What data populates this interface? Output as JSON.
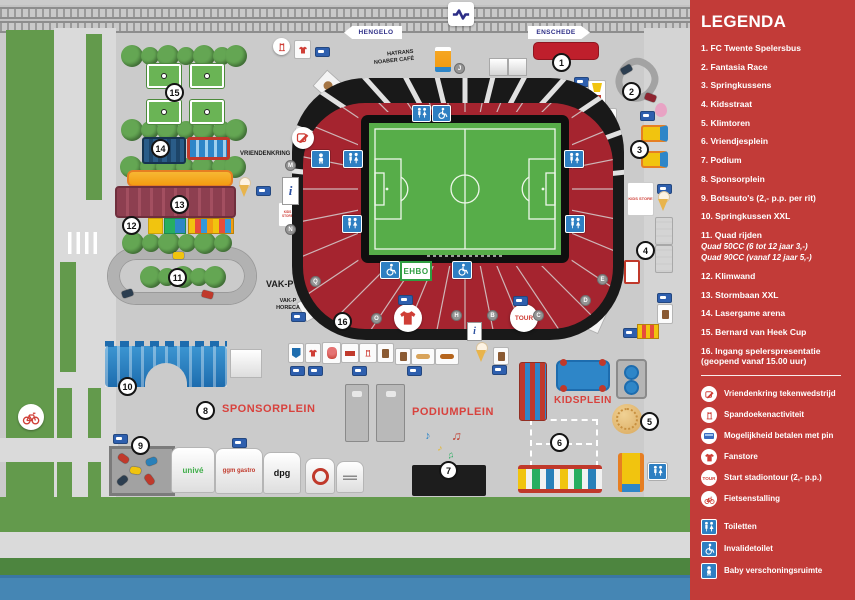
{
  "legend": {
    "title": "LEGENDA",
    "items": [
      "1. FC Twente Spelersbus",
      "2. Fantasia Race",
      "3. Springkussens",
      "4. Kidsstraat",
      "5. Klimtoren",
      "6. Vriendjesplein",
      "7. Podium",
      "8. Sponsorplein",
      "9. Botsauto's (2,- p.p. per rit)",
      "10. Springkussen XXL",
      "11. Quad rijden",
      "12. Klimwand",
      "13. Stormbaan XXL",
      "14. Lasergame arena",
      "15. Bernard van Heek Cup",
      "16. Ingang spelerspresentatie (geopend vanaf 15.00 uur)"
    ],
    "item11_sub": [
      "Quad 50CC (6 tot 12 jaar 3,-)",
      "Quad 90CC (vanaf 12 jaar 5,-)"
    ],
    "icon_items": [
      {
        "icon": "drawing-contest-icon",
        "label": "Vriendenkring tekenwedstrijd"
      },
      {
        "icon": "banner-activity-icon",
        "label": "Spandoekenactiviteit"
      },
      {
        "icon": "pin-payment-icon",
        "label": "Mogelijkheid betalen met pin"
      },
      {
        "icon": "fanstore-icon",
        "label": "Fanstore"
      },
      {
        "icon": "stadium-tour-icon",
        "label": "Start stadiontour (2,- p.p.)"
      },
      {
        "icon": "bicycle-parking-icon",
        "label": "Fietsenstalling"
      }
    ],
    "facility_items": [
      {
        "icon": "toilets-icon",
        "label": "Toiletten"
      },
      {
        "icon": "disabled-toilet-icon",
        "label": "Invalidetoilet"
      },
      {
        "icon": "baby-room-icon",
        "label": "Baby verschoningsruimte"
      }
    ],
    "tour_text": "TOUR"
  },
  "map": {
    "station": {
      "hengelo": "HENGELO",
      "enschede": "ENSCHEDE"
    },
    "labels": {
      "hatrans_1": "HATRANS",
      "hatrans_2": "NOABER CAFÉ",
      "vriendenkring": "VRIENDENKRING",
      "vak_p": "VAK-P",
      "vak_p_horeca": "VAK-P HORECA",
      "sponsorplein": "SPONSORPLEIN",
      "podiumplein": "PODIUMPLEIN",
      "kidsplein": "KIDSPLEIN",
      "ehbo": "EHBO",
      "tour": "TOUR",
      "info": "i",
      "kids_store": "KIDS STORE"
    },
    "markers": [
      "1",
      "2",
      "3",
      "4",
      "5",
      "6",
      "7",
      "8",
      "9",
      "10",
      "11",
      "12",
      "13",
      "14",
      "15",
      "16"
    ],
    "section_letters": [
      "M",
      "N",
      "Q",
      "O",
      "H",
      "B",
      "C",
      "D",
      "E",
      "J"
    ],
    "sponsors": [
      "univé",
      "ggm gastro",
      "dpg"
    ],
    "music_notes": [
      "♪",
      "♫",
      "♪",
      "♫"
    ]
  },
  "colors": {
    "legend_red": "#c23b38",
    "accent_red": "#d8423d",
    "stands_red": "#a5242f",
    "pitch_green": "#57ad49",
    "water_blue": "#4586b4",
    "icon_blue": "#2e7fc2",
    "ns_blue": "#2d2e87"
  }
}
